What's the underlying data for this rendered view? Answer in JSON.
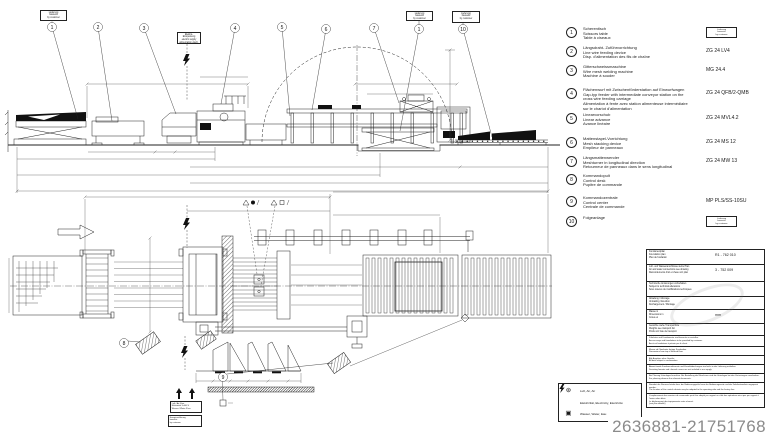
{
  "drawing": {
    "balloons_elevation": [
      "1",
      "2",
      "3",
      "4",
      "5",
      "6",
      "7",
      "1",
      "10"
    ],
    "balloons_plan": [
      "8",
      "9"
    ],
    "stamps": {
      "s1": "Lieferung\nbauseits\nby customer",
      "s2": "Elektro-Einspeisung\nelectric supply\nalimentation électr.",
      "s3": "Lieferung\nbauseits\nby customer",
      "s4": "Lieferung\nbauseits\nby customer"
    },
    "mini_boxes": {
      "b1": "Luft / Air 6 bar\nElektrizität 3×400 V\nWasser / Water 3 bar",
      "b2": "Energiezuführung\nbauseits\nby customer"
    }
  },
  "legend": {
    "items": [
      {
        "num": "1",
        "desc": "Scherentisch\nScissors table\nTable à ciseaux",
        "type": "",
        "stamp": "Lieferung\nbauseits\nby customer"
      },
      {
        "num": "2",
        "desc": "Längsdraht- Zuführvorrichtung\nLine wire feeding device\nDisp. d'alimentation des fils de chaîne",
        "type": "ZG 24 LV4",
        "stamp": ""
      },
      {
        "num": "3",
        "desc": "Gitterschweissmaschine\nWire mesh welding machine\nMachine à souder",
        "type": "MG 24.4",
        "stamp": ""
      },
      {
        "num": "4",
        "desc": "Flächenwurf mit Zwischenförderstation auf Einwurfwagen\nGap-typ feeder with intermediate conveyor station on the cross wire feeding carriage\nAlimentation à fente avec station alimenteuse intermédiaire sur le chariot d'alimentation",
        "type": "ZG 24 QFB/2-QMB",
        "stamp": ""
      },
      {
        "num": "5",
        "desc": "Linearvorschub\nLinear advance\nAvance linéaire",
        "type": "ZG 24 MVL4.2",
        "stamp": ""
      },
      {
        "num": "6",
        "desc": "Mattenstapel-Vorrichtung\nMesh stacking device\nEmpileur de panneaux",
        "type": "ZG 24 MS 12",
        "stamp": ""
      },
      {
        "num": "7",
        "desc": "Längsmattenwender\nMeshturner in longitudinal direction\nRetourneur de panneaux dans le sens longitudinal",
        "type": "ZG 24 MW 13",
        "stamp": ""
      },
      {
        "num": "8",
        "desc": "Kommandopult\nControl desk\nPupitre de commande",
        "type": "",
        "stamp": ""
      },
      {
        "num": "9",
        "desc": "Kommandozentrale\nControl center\nCentrale de commande",
        "type": "MP PLS/SS-10SU",
        "stamp": ""
      },
      {
        "num": "10",
        "desc": "Folgeanlage",
        "type": "",
        "stamp": "Lieferung\nbauseits\nby customer"
      }
    ]
  },
  "utilities": {
    "rows": [
      {
        "icon": "air-icon",
        "label": "Luft, Air, Air"
      },
      {
        "icon": "electricity-icon",
        "label": "Elektrizität, Electricity, Electricité"
      },
      {
        "icon": "water-icon",
        "label": "Wasser, Water, Eau"
      }
    ]
  },
  "title_block": {
    "rows": [
      {
        "label": "Fundamentplan\nFoundation plan\nPlan de fondation",
        "value": "R1 - 762 010"
      },
      {
        "label": "Luft- und Wasseranschlüsse siehe Plan\nAir and water connections see drawing\nRaccordements d'air et d'eau voir plan",
        "value": "3 - 752 009"
      },
      {
        "label": "Technische Änderungen vorbehalten\nSubject to technical alterations\nSous réserve de modifications techniques",
        "value": ""
      },
      {
        "label": "Abladung / Montage\nUnloading / Erection\nDéchargement / Montage",
        "value": ""
      },
      {
        "label": "Masse in\nDimensions in\nCotes en",
        "value": "mm"
      },
      {
        "label": "Gewichte siehe Transportliste\nWeights see transport list\nPoids voir liste de transport",
        "value": ""
      }
    ],
    "notes": [
      "Zufahrten und Fundamente sind bauseits zu erstellen.\nAccess ways and foundations to be provided by customer.\nAccès et fondations à prévoir par le client.",
      "Masse ab Oberkante fertiger Fussboden.\nDimensions from top of finished floor.",
      "Alle Angaben ohne Gewähr.\nAll data subject to confirmation.",
      "Abweichende Fundamentformate und Kanalabdeckungen sind nicht in der Lieferung enthalten.\nDeviating formats and channel covers are not included in our supply.",
      "Bei Planung Unterlagen beachten. Bei Bestellung der Maschinen sind die Unterlagen bei den Vertretungen anzufordern.\nFor planning observe the relevant documents.",
      "Standort der Steuerschränke bzw. der Bedienungspulte kann der Bedienungsseite und der Fabrikationslinie angepasst werden.\nThe location of the control cabinets may be adapted to the operating side and the factory line.",
      "L'emplacement des armoires de commande peut être adapté par rapport au côté des opérations ainsi que par rapport à l'usine selon désir.\nLe déplacement des équipements reste réservé.\n(voir plan détaillé)"
    ]
  },
  "footer": {
    "listing_number": "2636881-21751768"
  }
}
